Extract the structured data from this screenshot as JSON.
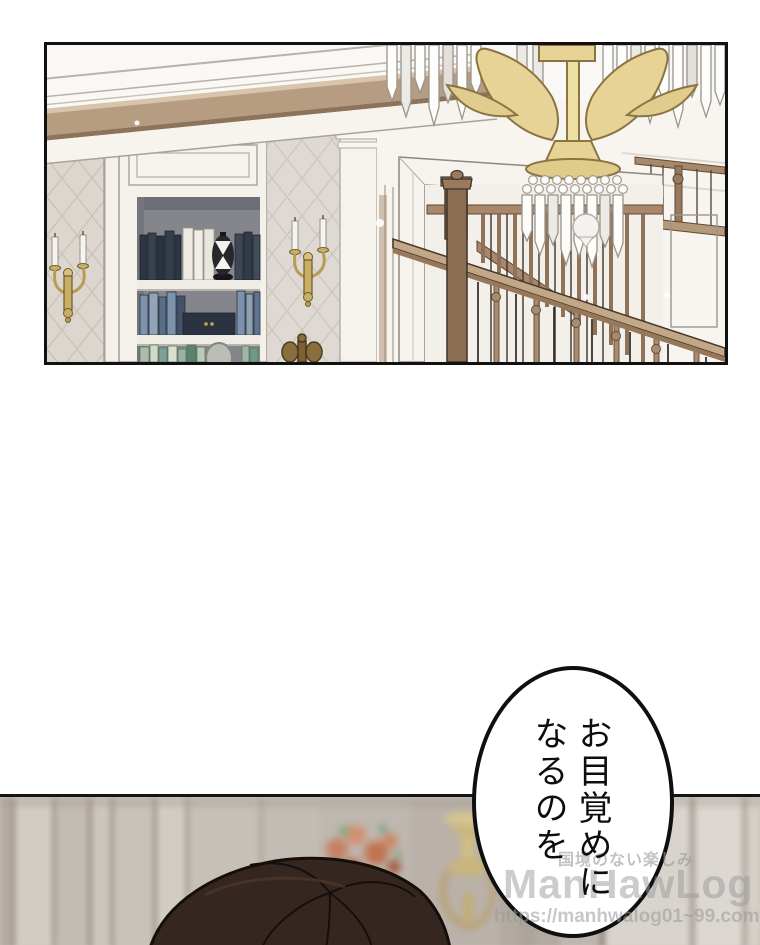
{
  "speech_bubble": {
    "line1": "お目覚めに",
    "line2": "なるのを"
  },
  "watermark": {
    "tagline": "国境のない楽しみ",
    "logo": "ManHawLog",
    "url": "https://manhwalog01~99.com"
  },
  "colors": {
    "panel_border": "#111111",
    "page_background": "#ffffff",
    "bubble_background": "#ffffff",
    "bubble_text": "#0d0d0d",
    "watermark_gray": "#9a9a9a",
    "ceiling_beam": "#b69d82",
    "wallpaper": "#dcd6cf",
    "bookcase_white": "#f4f1eb",
    "shelf_alcove_gray": "#85868c",
    "books_navy": "#2e3643",
    "books_blue": "#7d92ac",
    "books_green": "#aabfa8",
    "sconce_gold": "#c9ae66",
    "chandelier_gold": "#e7d396",
    "crystal_white": "#fdfdfc",
    "stair_wood": "#a8876a",
    "blurred_wall": "#c8c1b9",
    "flowers": "#c67f5f",
    "hair_dark_brown": "#362620"
  }
}
